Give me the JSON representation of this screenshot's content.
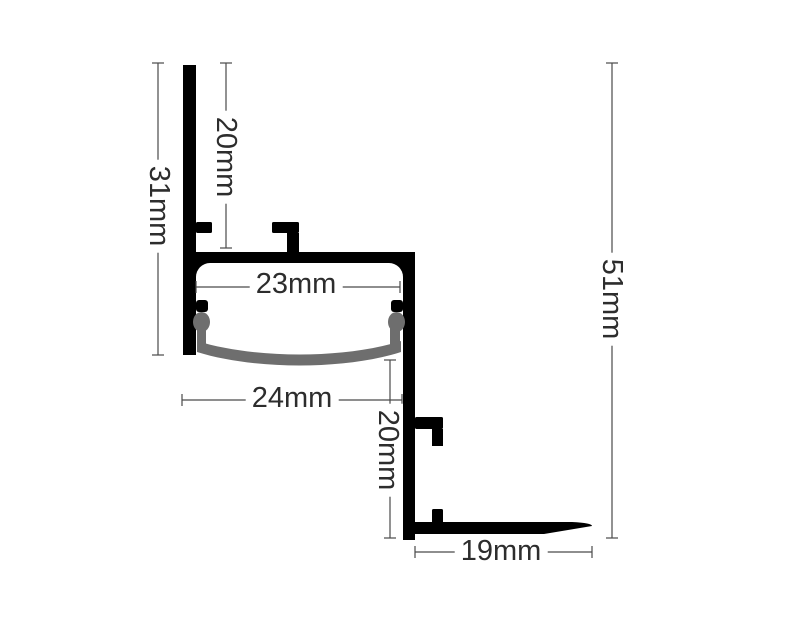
{
  "dimensions": {
    "left_wall_height": "31mm",
    "upper_channel_depth": "20mm",
    "inner_width": "23mm",
    "outer_width": "24mm",
    "lower_drop": "20mm",
    "overall_height": "51mm",
    "bottom_flange_width": "19mm"
  },
  "colors": {
    "profile": "#000000",
    "diffuser": "#6e6e6e",
    "dimension_lines": "#4a4a4a",
    "label_text": "#2d2d2d",
    "background": "#ffffff"
  }
}
